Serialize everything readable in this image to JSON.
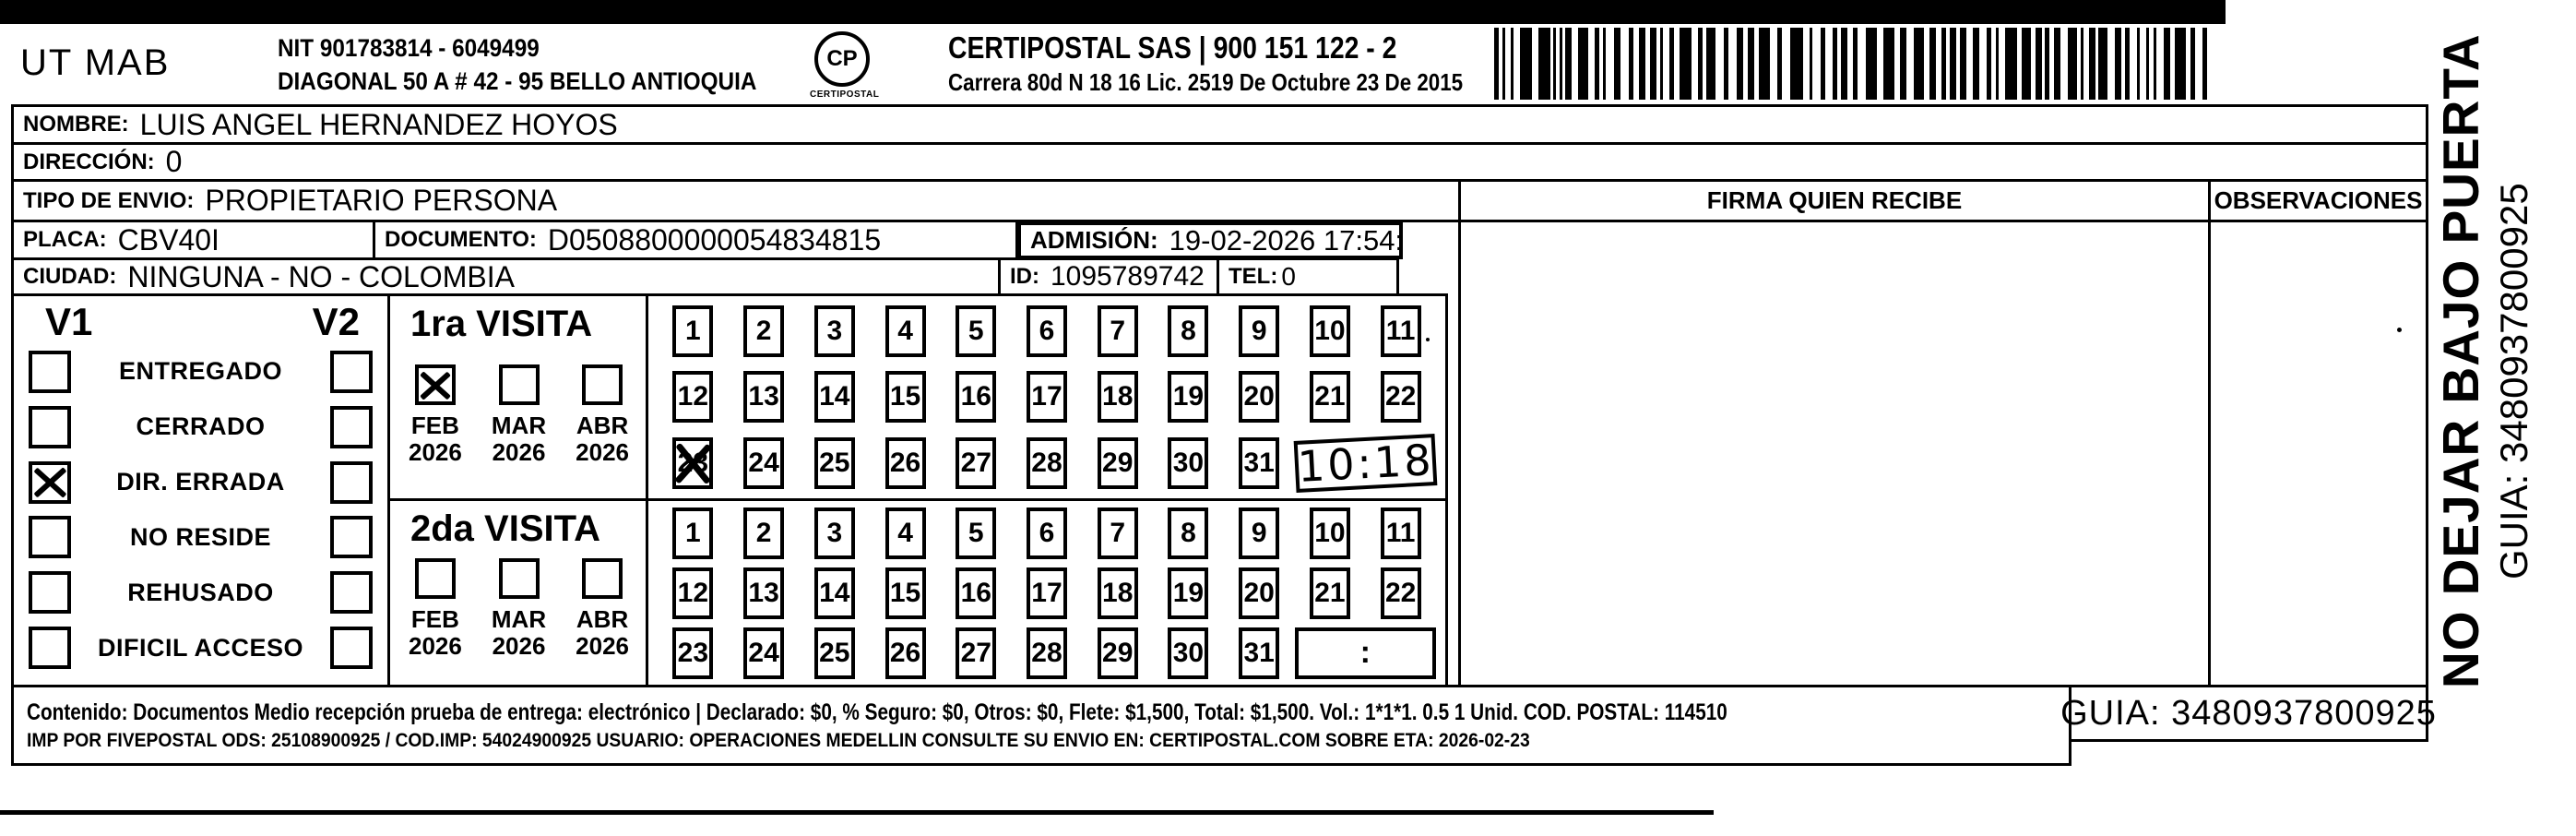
{
  "header": {
    "sender": "UT MAB",
    "nit_line1": "NIT 901783814 - 6049499",
    "nit_line2": "DIAGONAL 50 A # 42 - 95  BELLO  ANTIOQUIA",
    "logo_monogram": "CP",
    "logo_name": "CERTIPOSTAL",
    "company_line1": "CERTIPOSTAL SAS | 900 151 122 - 2",
    "company_line2": "Carrera 80d N 18 16  Lic. 2519 De Octubre 23 De 2015"
  },
  "fields": {
    "nombre_label": "NOMBRE:",
    "nombre_value": "LUIS ANGEL HERNANDEZ HOYOS",
    "direccion_label": "DIRECCIÓN:",
    "direccion_value": "0",
    "tipo_envio_label": "TIPO DE ENVIO:",
    "tipo_envio_value": "PROPIETARIO PERSONA",
    "placa_label": "PLACA:",
    "placa_value": "CBV40I",
    "documento_label": "DOCUMENTO:",
    "documento_value": "D0508800000054834815",
    "admision_label": "ADMISIÓN:",
    "admision_value": "19-02-2026 17:54:45",
    "ciudad_label": "CIUDAD:",
    "ciudad_value": "NINGUNA - NO - COLOMBIA",
    "id_label": "ID:",
    "id_value": "1095789742",
    "tel_label": "TEL:",
    "tel_value": "0",
    "firma_header": "FIRMA QUIEN RECIBE",
    "observaciones_header": "OBSERVACIONES"
  },
  "status_panel": {
    "col1_header": "V1",
    "col2_header": "V2",
    "rows": [
      {
        "label": "ENTREGADO",
        "v1_checked": false,
        "v2_checked": false
      },
      {
        "label": "CERRADO",
        "v1_checked": false,
        "v2_checked": false
      },
      {
        "label": "DIR. ERRADA",
        "v1_checked": true,
        "v2_checked": false
      },
      {
        "label": "NO RESIDE",
        "v1_checked": false,
        "v2_checked": false
      },
      {
        "label": "REHUSADO",
        "v1_checked": false,
        "v2_checked": false
      },
      {
        "label": "DIFICIL ACCESO",
        "v1_checked": false,
        "v2_checked": false
      }
    ]
  },
  "visits": [
    {
      "title": "1ra VISITA",
      "months": [
        {
          "month": "FEB",
          "year": "2026",
          "checked": true
        },
        {
          "month": "MAR",
          "year": "2026",
          "checked": false
        },
        {
          "month": "ABR",
          "year": "2026",
          "checked": false
        }
      ],
      "day_rows": [
        [
          1,
          2,
          3,
          4,
          5,
          6,
          7,
          8,
          9,
          10,
          11
        ],
        [
          12,
          13,
          14,
          15,
          16,
          17,
          18,
          19,
          20,
          21,
          22
        ],
        [
          23,
          24,
          25,
          26,
          27,
          28,
          29,
          30,
          31
        ]
      ],
      "crossed_days": [
        23
      ],
      "time_value": "10:18",
      "time_handwritten": true
    },
    {
      "title": "2da VISITA",
      "months": [
        {
          "month": "FEB",
          "year": "2026",
          "checked": false
        },
        {
          "month": "MAR",
          "year": "2026",
          "checked": false
        },
        {
          "month": "ABR",
          "year": "2026",
          "checked": false
        }
      ],
      "day_rows": [
        [
          1,
          2,
          3,
          4,
          5,
          6,
          7,
          8,
          9,
          10,
          11
        ],
        [
          12,
          13,
          14,
          15,
          16,
          17,
          18,
          19,
          20,
          21,
          22
        ],
        [
          23,
          24,
          25,
          26,
          27,
          28,
          29,
          30,
          31
        ]
      ],
      "crossed_days": [],
      "time_value": ":",
      "time_handwritten": false
    }
  ],
  "footer": {
    "line1": "Contenido: Documentos Medio recepción prueba de entrega: electrónico | Declarado: $0, % Seguro: $0, Otros: $0, Flete: $1,500, Total: $1,500. Vol.: 1*1*1. 0.5  1 Unid. COD. POSTAL: 114510",
    "line2": "IMP POR FIVEPOSTAL ODS: 25108900925 / COD.IMP: 54024900925 USUARIO: OPERACIONES MEDELLIN CONSULTE SU ENVIO EN: CERTIPOSTAL.COM SOBRE ETA: 2026-02-23",
    "guia_value": "GUIA: 3480937800925"
  },
  "side_strip": {
    "warning": "NO DEJAR BAJO PUERTA",
    "guia": "GUIA: 3480937800925"
  },
  "colors": {
    "ink": "#000000",
    "paper": "#ffffff"
  }
}
